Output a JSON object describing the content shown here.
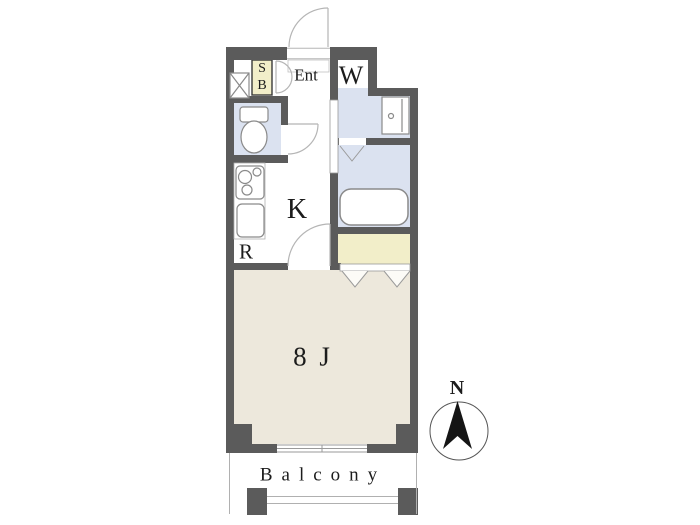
{
  "floorplan": {
    "labels": {
      "entrance": "Ent",
      "shoe_box_line1": "S",
      "shoe_box_line2": "B",
      "washer": "W",
      "kitchen": "K",
      "refrigerator": "R",
      "main_room": "8 J",
      "balcony": "Balcony",
      "compass_north": "N"
    },
    "colors": {
      "wall": "#5b5b5b",
      "wet_area_blue": "#dbe2f0",
      "closet_cream": "#f2eec9",
      "room_beige": "#ede8dc",
      "floor_white": "#ffffff",
      "fixture_line": "#8a8a8a",
      "door_arc": "#b5b5b5",
      "compass_black": "#151515"
    },
    "icons": [
      "pipe-space-icon",
      "shoe-box-icon",
      "toilet-icon",
      "stove-icon",
      "kitchen-sink-icon",
      "washbasin-icon",
      "bathtub-icon",
      "entrance-door-icon",
      "sliding-window-icon",
      "folding-door-icon",
      "north-compass-icon"
    ]
  }
}
